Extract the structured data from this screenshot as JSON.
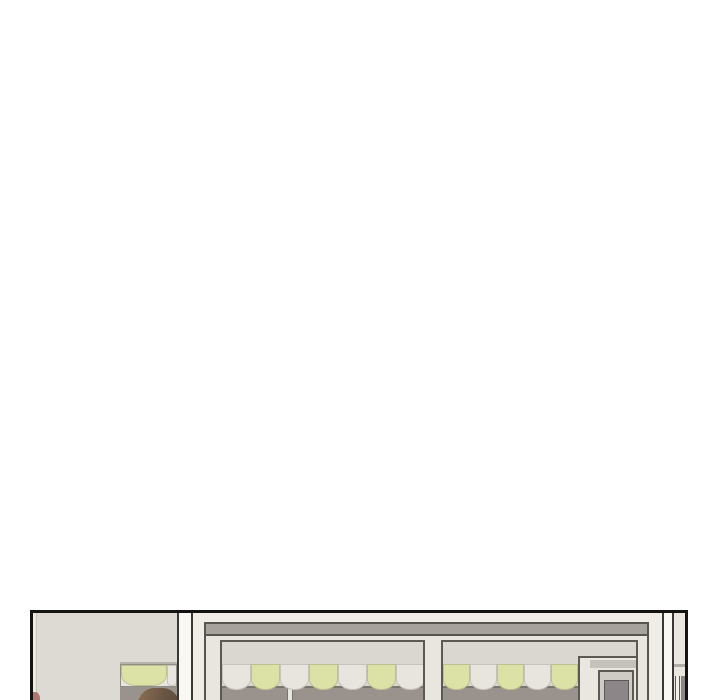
{
  "scene": {
    "type": "webtoon-panel",
    "description": "Top edge of a comic panel showing a storefront exterior: beige side wall, white pillars, two large shop windows with scalloped awnings, a recessed door, a neighboring shop sliver, and the top of a brown-haired person's head entering at bottom-left"
  },
  "colors": {
    "page_bg": "#ffffff",
    "panel_border": "#141311",
    "wall": "#dcdad2",
    "wall_edge": "#ebe9e2",
    "pillar": "#f9f8f3",
    "pillar_edge": "#3a3836",
    "storefront_wall": "#efede6",
    "bay_fill": "#e8e6df",
    "bay_outline": "#57554f",
    "fascia": "#a8a29c",
    "window_frame": "#5b5953",
    "glass": "#d9d7d0",
    "awning_green": "#dce2a6",
    "awning_white": "#e7e5de",
    "lower_pane": "#9a938d",
    "pane_edge": "#7a756f",
    "mullion": "#e8e6df",
    "door_surround": "#e9e7e0",
    "door_recess": "#cfccc5",
    "door_slab": "#8d8689",
    "lintel": "#c5c2bb",
    "sliver_wall": "#e9e7e0",
    "sliver_line": "#b0ada6",
    "hair": "#6b5645",
    "hair_light": "#83694e",
    "skin": "#cfa883",
    "red_fragment": "#b0756c"
  },
  "awnings": {
    "left_window": {
      "cells": [
        {
          "color": "white",
          "width": 29
        },
        {
          "color": "green",
          "width": 29
        },
        {
          "color": "white",
          "width": 29
        },
        {
          "color": "green",
          "width": 29
        },
        {
          "color": "white",
          "width": 29
        },
        {
          "color": "green",
          "width": 29
        },
        {
          "color": "white",
          "width": 29
        }
      ]
    },
    "right_window": {
      "cells": [
        {
          "color": "green",
          "width": 27
        },
        {
          "color": "white",
          "width": 27
        },
        {
          "color": "green",
          "width": 27
        },
        {
          "color": "white",
          "width": 27
        },
        {
          "color": "green",
          "width": 27
        }
      ]
    },
    "wall_window": {
      "cells": [
        {
          "color": "green",
          "width": 46
        },
        {
          "color": "white",
          "width": 10
        }
      ]
    }
  }
}
